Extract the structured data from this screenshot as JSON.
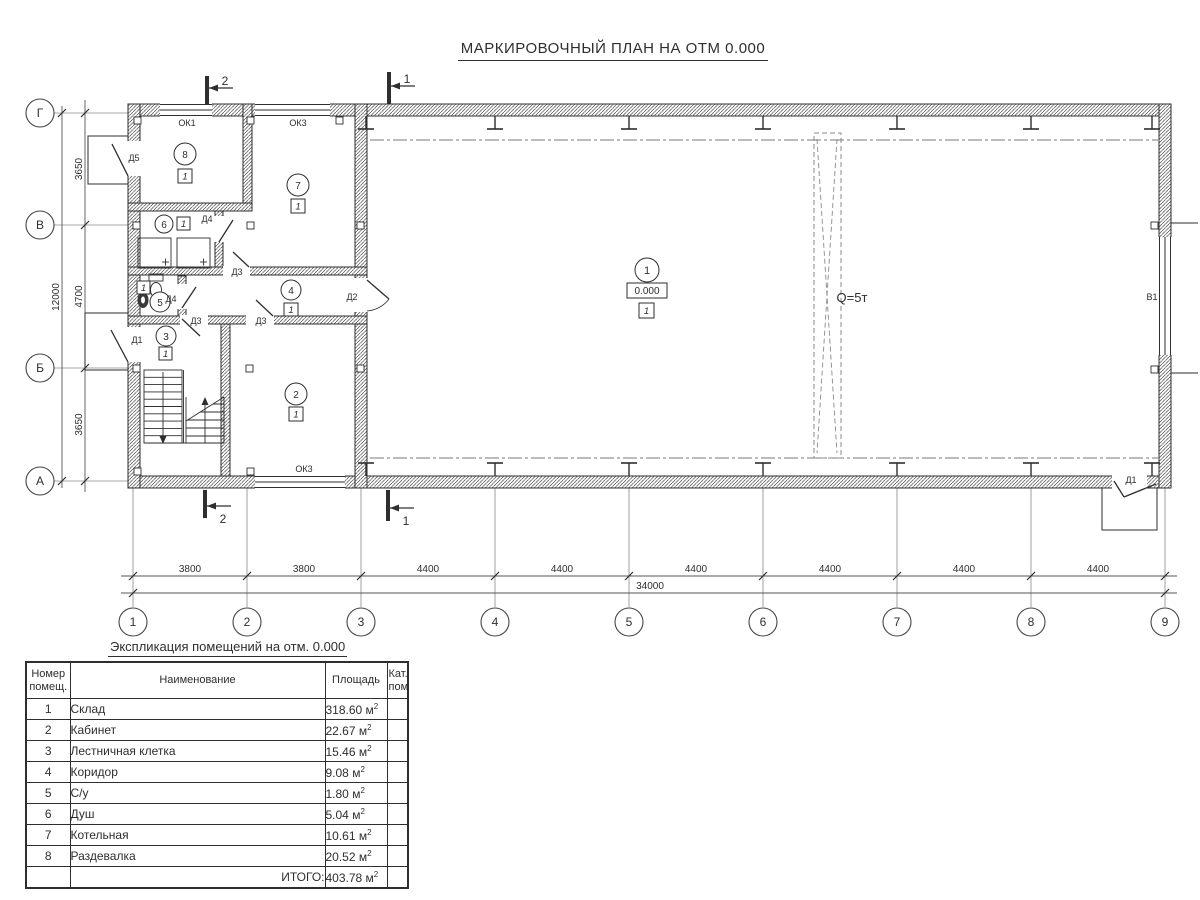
{
  "title": "МАРКИРОВОЧНЫЙ ПЛАН НА ОТМ 0.000",
  "plan": {
    "rooms": [
      {
        "number": "1",
        "category": "1",
        "elevation": "0.000"
      },
      {
        "number": "2",
        "category": "1"
      },
      {
        "number": "3",
        "category": "1"
      },
      {
        "number": "4",
        "category": "1"
      },
      {
        "number": "5",
        "category": "1"
      },
      {
        "number": "6",
        "category": "1"
      },
      {
        "number": "7",
        "category": "1"
      },
      {
        "number": "8",
        "category": "1"
      }
    ],
    "labels": {
      "crane": "Q=5т",
      "gate": "В1",
      "window_ok1": "ОК1",
      "window_ok3": "ОК3",
      "door_d1": "Д1",
      "door_d2": "Д2",
      "door_d3": "Д3",
      "door_d4": "Д4",
      "door_d5": "Д5"
    },
    "section_markers": {
      "s1": "1",
      "s2": "2"
    },
    "axes": {
      "horizontal": [
        "1",
        "2",
        "3",
        "4",
        "5",
        "6",
        "7",
        "8",
        "9"
      ],
      "vertical": [
        "Г",
        "В",
        "Б",
        "А"
      ]
    },
    "dimensions": {
      "bottom_spans": [
        "3800",
        "3800",
        "4400",
        "4400",
        "4400",
        "4400",
        "4400",
        "4400"
      ],
      "bottom_total": "34000",
      "left_spans": [
        "3650",
        "4700",
        "3650"
      ],
      "left_total": "12000"
    }
  },
  "table": {
    "title": "Экспликация помещений на отм. 0.000",
    "headers": [
      "Номер помещ.",
      "Наименование",
      "Площадь",
      "Кат. пом."
    ],
    "unit": "м",
    "unit_sup": "2",
    "rows": [
      {
        "num": "1",
        "name": "Склад",
        "area": "318.60"
      },
      {
        "num": "2",
        "name": "Кабинет",
        "area": "22.67"
      },
      {
        "num": "3",
        "name": "Лестничная клетка",
        "area": "15.46"
      },
      {
        "num": "4",
        "name": "Коридор",
        "area": "9.08"
      },
      {
        "num": "5",
        "name": "С/у",
        "area": "1.80"
      },
      {
        "num": "6",
        "name": "Душ",
        "area": "5.04"
      },
      {
        "num": "7",
        "name": "Котельная",
        "area": "10.61"
      },
      {
        "num": "8",
        "name": "Раздевалка",
        "area": "20.52"
      }
    ],
    "total_label": "ИТОГО:",
    "total_area": "403.78"
  }
}
